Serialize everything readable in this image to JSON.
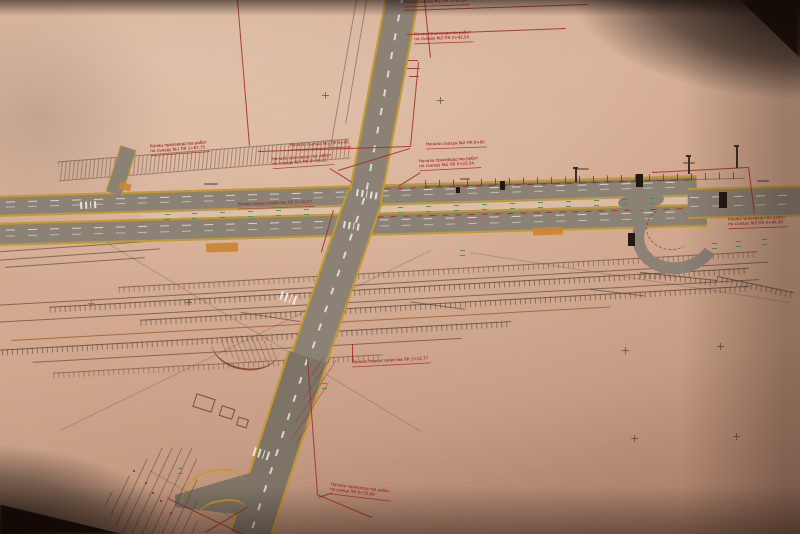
{
  "annotations": {
    "a1": {
      "line1": "Конец съезда №2 ПК 2+81,20"
    },
    "a2": {
      "line1": "Конец производства работ",
      "line2": "по съезду №2 ПК 2+42,54"
    },
    "a3": {
      "line1": "Конец производства работ",
      "line2": "по съезду №1 ПК 1+87,75"
    },
    "a4": {
      "line1": "Начало съезда №1 ПК 0+00"
    },
    "a5": {
      "line1": "Начало производства работ",
      "line2": "по съезду №1 ПК 0+19,11"
    },
    "a6": {
      "line1": "Начало съезда №2 ПК 0+00"
    },
    "a7": {
      "line1": "Начало производства работ",
      "line2": "по съезду №2 ПК 0+22,54"
    },
    "a8": {
      "line1": "Конец переустройства ПК 2+10,27"
    },
    "a9": {
      "line1": "Конец производства работ",
      "line2": "по съезду №3 ПК 0+94,30"
    },
    "a10": {
      "line1": "Начало переустройства ПК 1+12,77"
    },
    "a11": {
      "line1": "Начало производства работ",
      "line2": "по улице ПК 0+25,00"
    }
  },
  "colors": {
    "paper": "#d2a88f",
    "road_fill": "#8b8174",
    "edge_line_yellow": "#c49a2e",
    "red_ink": "#9c2620",
    "green_ink": "#4a8a3f",
    "orange_fill": "#cc8430",
    "rail_ink": "#5a443a",
    "photo_shadow": "#170b07"
  }
}
